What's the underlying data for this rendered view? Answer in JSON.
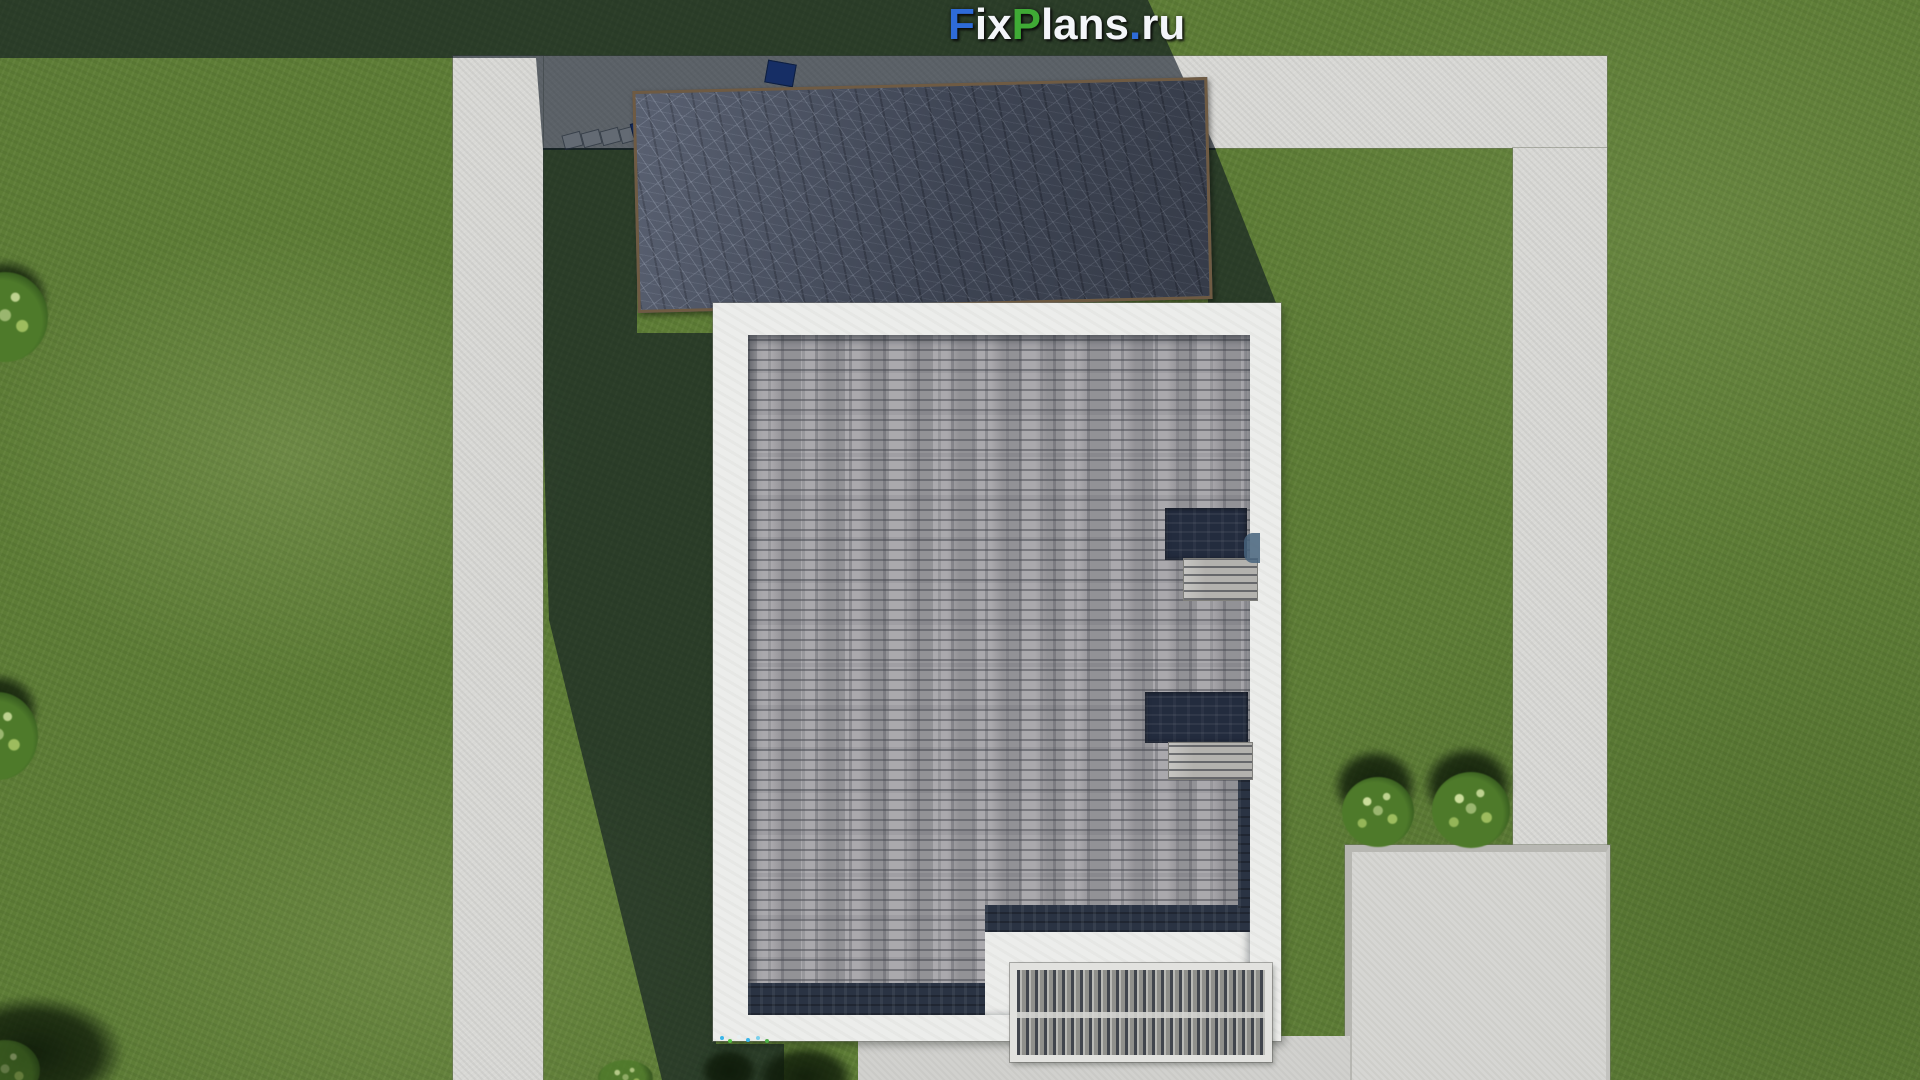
{
  "watermark": {
    "text": "FixPlans.ru",
    "segments": [
      {
        "t": "F",
        "color": "#2e6bd8"
      },
      {
        "t": "ix",
        "color": "#f3f5f9"
      },
      {
        "t": "P",
        "color": "#3faa35"
      },
      {
        "t": "lans",
        "color": "#f3f5f9"
      },
      {
        "t": ".",
        "color": "#2e6bd8"
      },
      {
        "t": "ru",
        "color": "#f3f5f9"
      }
    ]
  },
  "palette": {
    "grass_base": "#5d7c36",
    "path": "#d8d8d5",
    "pad": "#d6d6d3",
    "patio": "#d1d1ce",
    "shadow": "#0a1420",
    "parapet": "#ecedeb",
    "shingle": "#a3a2a6",
    "navy": "#2a3343",
    "slate": "#4b5365",
    "trim": "#6f5b43",
    "pergola_slat": "#b4b4b0",
    "pergola_dark": "#41454d",
    "bush": "#4e7a2a",
    "blue_accent": "#2a55cc"
  },
  "scene": {
    "view": "top-down aerial render of house plot",
    "objects": [
      "garage slate roof",
      "main flat shingle roof with white parapet",
      "two roof terrace insets",
      "two rooftop units",
      "louvered pergola grate",
      "concrete walkways",
      "concrete pad",
      "patio",
      "sun loungers",
      "bushes",
      "lawn"
    ],
    "counts": {
      "sun_loungers": 4,
      "bushes_right": 2,
      "bushes_left_edge": 2,
      "roof_insets": 2
    }
  }
}
